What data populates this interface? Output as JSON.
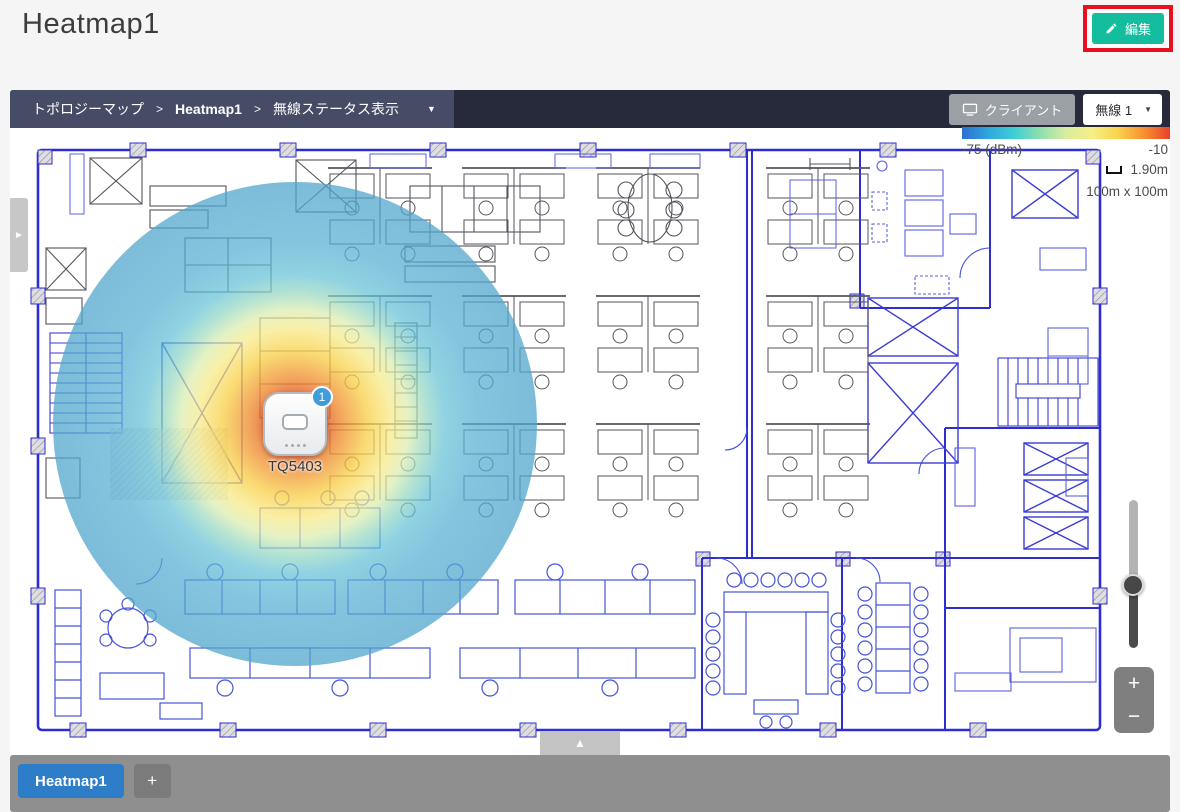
{
  "header": {
    "title": "Heatmap1",
    "edit_button": {
      "label": "編集",
      "icon": "pencil-icon",
      "color": "#13bd9d",
      "highlight_color": "#e8101e"
    }
  },
  "toolbar": {
    "breadcrumbs": [
      {
        "label": "トポロジーマップ",
        "separator": ">"
      },
      {
        "label": "Heatmap1",
        "separator": ">"
      },
      {
        "label": "無線ステータス表示",
        "separator": ""
      }
    ],
    "dropdown_caret": "▼",
    "client_button_label": "クライアント",
    "client_button_icon": "monitor-icon",
    "radio_dropdown": {
      "value": "無線 1",
      "caret": "▼"
    }
  },
  "legend": {
    "min_label": "-75 (dBm)",
    "max_label": "-10",
    "scale_label": "1.90m",
    "map_size_label": "100m x 100m",
    "gradient_colors": [
      "#2d6fd0",
      "#30a6dd",
      "#3ecfd4",
      "#8fdfae",
      "#d9eda0",
      "#f6ef86",
      "#fbd34c",
      "#f89030",
      "#e8402a"
    ]
  },
  "map": {
    "access_point": {
      "name": "TQ5403",
      "badge_count": "1"
    },
    "heatmap": {
      "center_color": "#d63726",
      "outer_color": "#4fa5cb"
    }
  },
  "controls": {
    "sidebar_handle": "►",
    "expand_tab": "▲",
    "zoom_in": "+",
    "zoom_out": "−"
  },
  "tab_bar": {
    "tabs": [
      {
        "label": "Heatmap1",
        "active": true
      }
    ],
    "add_button": "+"
  }
}
